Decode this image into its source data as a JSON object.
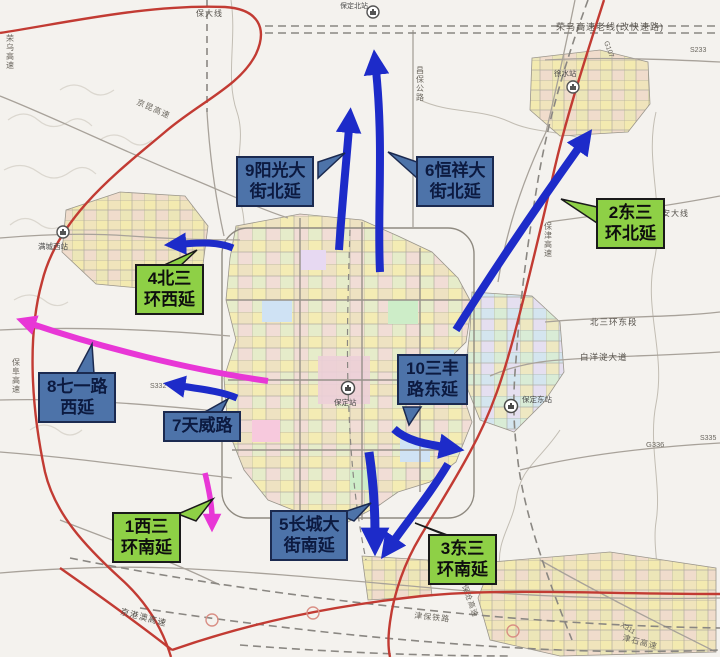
{
  "colors": {
    "arrow_blue": "#1d2bc9",
    "arrow_magenta": "#e837d6",
    "callout_blue_bg": "#4d73a9",
    "callout_green_bg": "#8ed046",
    "highway_red": "#c23b33",
    "road_gray": "#a8a29a"
  },
  "callouts": [
    {
      "num": "9",
      "line1": "9阳光大",
      "line2": "街北延",
      "style": "blue"
    },
    {
      "num": "6",
      "line1": "6恒祥大",
      "line2": "街北延",
      "style": "blue"
    },
    {
      "num": "2",
      "line1": "2东三",
      "line2": "环北延",
      "style": "green"
    },
    {
      "num": "4",
      "line1": "4北三",
      "line2": "环西延",
      "style": "green"
    },
    {
      "num": "8",
      "line1": "8七一路",
      "line2": "西延",
      "style": "blue"
    },
    {
      "num": "7",
      "line1": "7天威路",
      "line2": "",
      "style": "blue"
    },
    {
      "num": "10",
      "line1": "10三丰",
      "line2": "路东延",
      "style": "blue"
    },
    {
      "num": "1",
      "line1": "1西三",
      "line2": "环南延",
      "style": "green"
    },
    {
      "num": "5",
      "line1": "5长城大",
      "line2": "街南延",
      "style": "blue"
    },
    {
      "num": "3",
      "line1": "3东三",
      "line2": "环南延",
      "style": "green"
    }
  ],
  "map_labels": {
    "rongwu": "荣乌高速",
    "baoda": "保大线",
    "rongwu_old": "荣乌高速老线(改快速路)",
    "s233": "S233",
    "g107": "G107",
    "anda": "安大线",
    "changbao": "昌保公路",
    "jingkun": "京昆高速",
    "baojin": "保津高速",
    "beisanhuan_east": "北三环东段",
    "baiyangdian": "白洋淀大道",
    "g336": "G336",
    "s335": "S335",
    "baofu": "保阜高速",
    "s332": "S332",
    "jinggangao": "京港澳高速",
    "jinbao_rail": "津保铁路",
    "x311": "X311",
    "jinshi": "津石高速",
    "baocang": "保沧高速"
  },
  "stations": {
    "baoding_north": "保定北站",
    "xushui": "徐水站",
    "mancheng_west": "满城西站",
    "baoding": "保定站",
    "baoding_east": "保定东站"
  }
}
